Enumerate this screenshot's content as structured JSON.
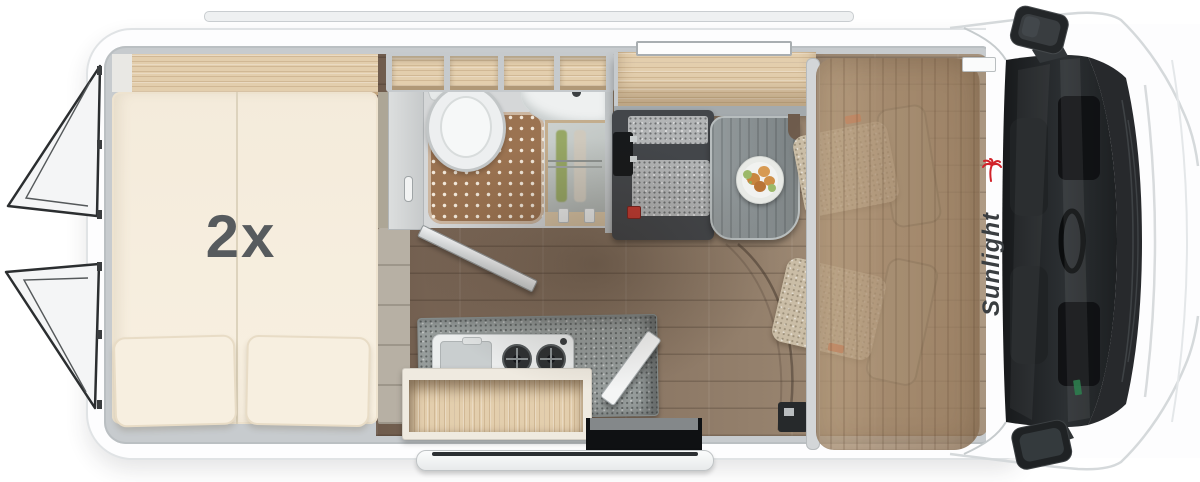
{
  "page": {
    "background": "#ffffff",
    "subject": "motorhome floor plan, top view"
  },
  "floorplan": {
    "bed_label": "2x",
    "brand": "Sunlight"
  },
  "colors": {
    "brand_red": "#d1232a",
    "logo_text": "#3a3e41",
    "bed_cream": "#f6eedf",
    "wood_shelf": "#e3cead",
    "floor_wood": "#8d7966",
    "shower_mat": "#9b7351",
    "counter_gray": "#979d9c",
    "bench_dark": "#43464a",
    "cushion_speckle": "#b4b6b7",
    "table_gray": "#8b9294",
    "overcab_wood": "#a98b6d",
    "windshield_dark": "#1d2022",
    "body_white": "#fdfdfe",
    "wall_gray": "#c7cbce",
    "seatbelt_red": "#c23a31",
    "seat_tag_orange": "#e65c2e",
    "sticker_green": "#2e7d4e"
  },
  "icons": {
    "brand_palm": "palm-icon",
    "plate": "meal-plate-icon"
  }
}
